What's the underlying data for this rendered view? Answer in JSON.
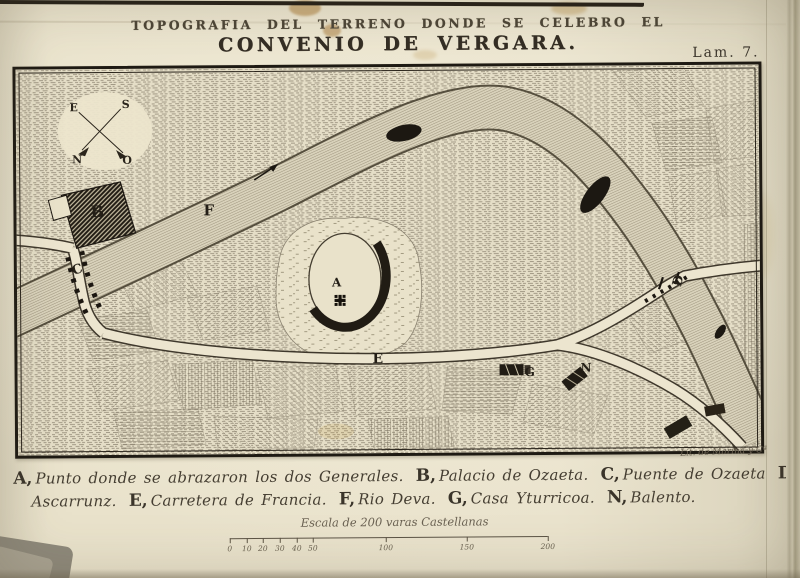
{
  "page": {
    "plate_label": "Lam. 7."
  },
  "title": {
    "kicker": "TOPOGRAFIA DEL TERRENO DONDE SE CELEBRO EL",
    "main": "CONVENIO DE VERGARA."
  },
  "map": {
    "point_labels": {
      "A": "A",
      "B": "B",
      "C": "C",
      "D": "D",
      "E": "E",
      "F": "F",
      "G": "G",
      "N": "N"
    },
    "compass": {
      "east": "E",
      "south": "S",
      "north": "N",
      "west": "O"
    },
    "signature": "Lit. de Marina y Cª"
  },
  "caption": {
    "line1": [
      {
        "key": "A,",
        "text": "Punto donde se abrazaron los dos Generales."
      },
      {
        "key": "B,",
        "text": "Palacio de Ozaeta."
      },
      {
        "key": "C,",
        "text": "Puente de Ozaeta"
      },
      {
        "key": "D,",
        "text": "Puente de"
      }
    ],
    "line2": [
      {
        "key": "",
        "text": "Ascarrunz."
      },
      {
        "key": "E,",
        "text": "Carretera de Francia."
      },
      {
        "key": "F,",
        "text": "Rio Deva."
      },
      {
        "key": "G,",
        "text": "Casa Yturricoa."
      },
      {
        "key": "N,",
        "text": "Balento."
      }
    ]
  },
  "scale": {
    "label": "Escala de 200 varas Castellanas",
    "ticks": [
      "0",
      "10",
      "20",
      "30",
      "40",
      "50",
      "100",
      "150",
      "200"
    ]
  },
  "colors": {
    "paper": "#e7e0c9",
    "ink": "#2b251c",
    "map_bg": "#e5dec7"
  }
}
